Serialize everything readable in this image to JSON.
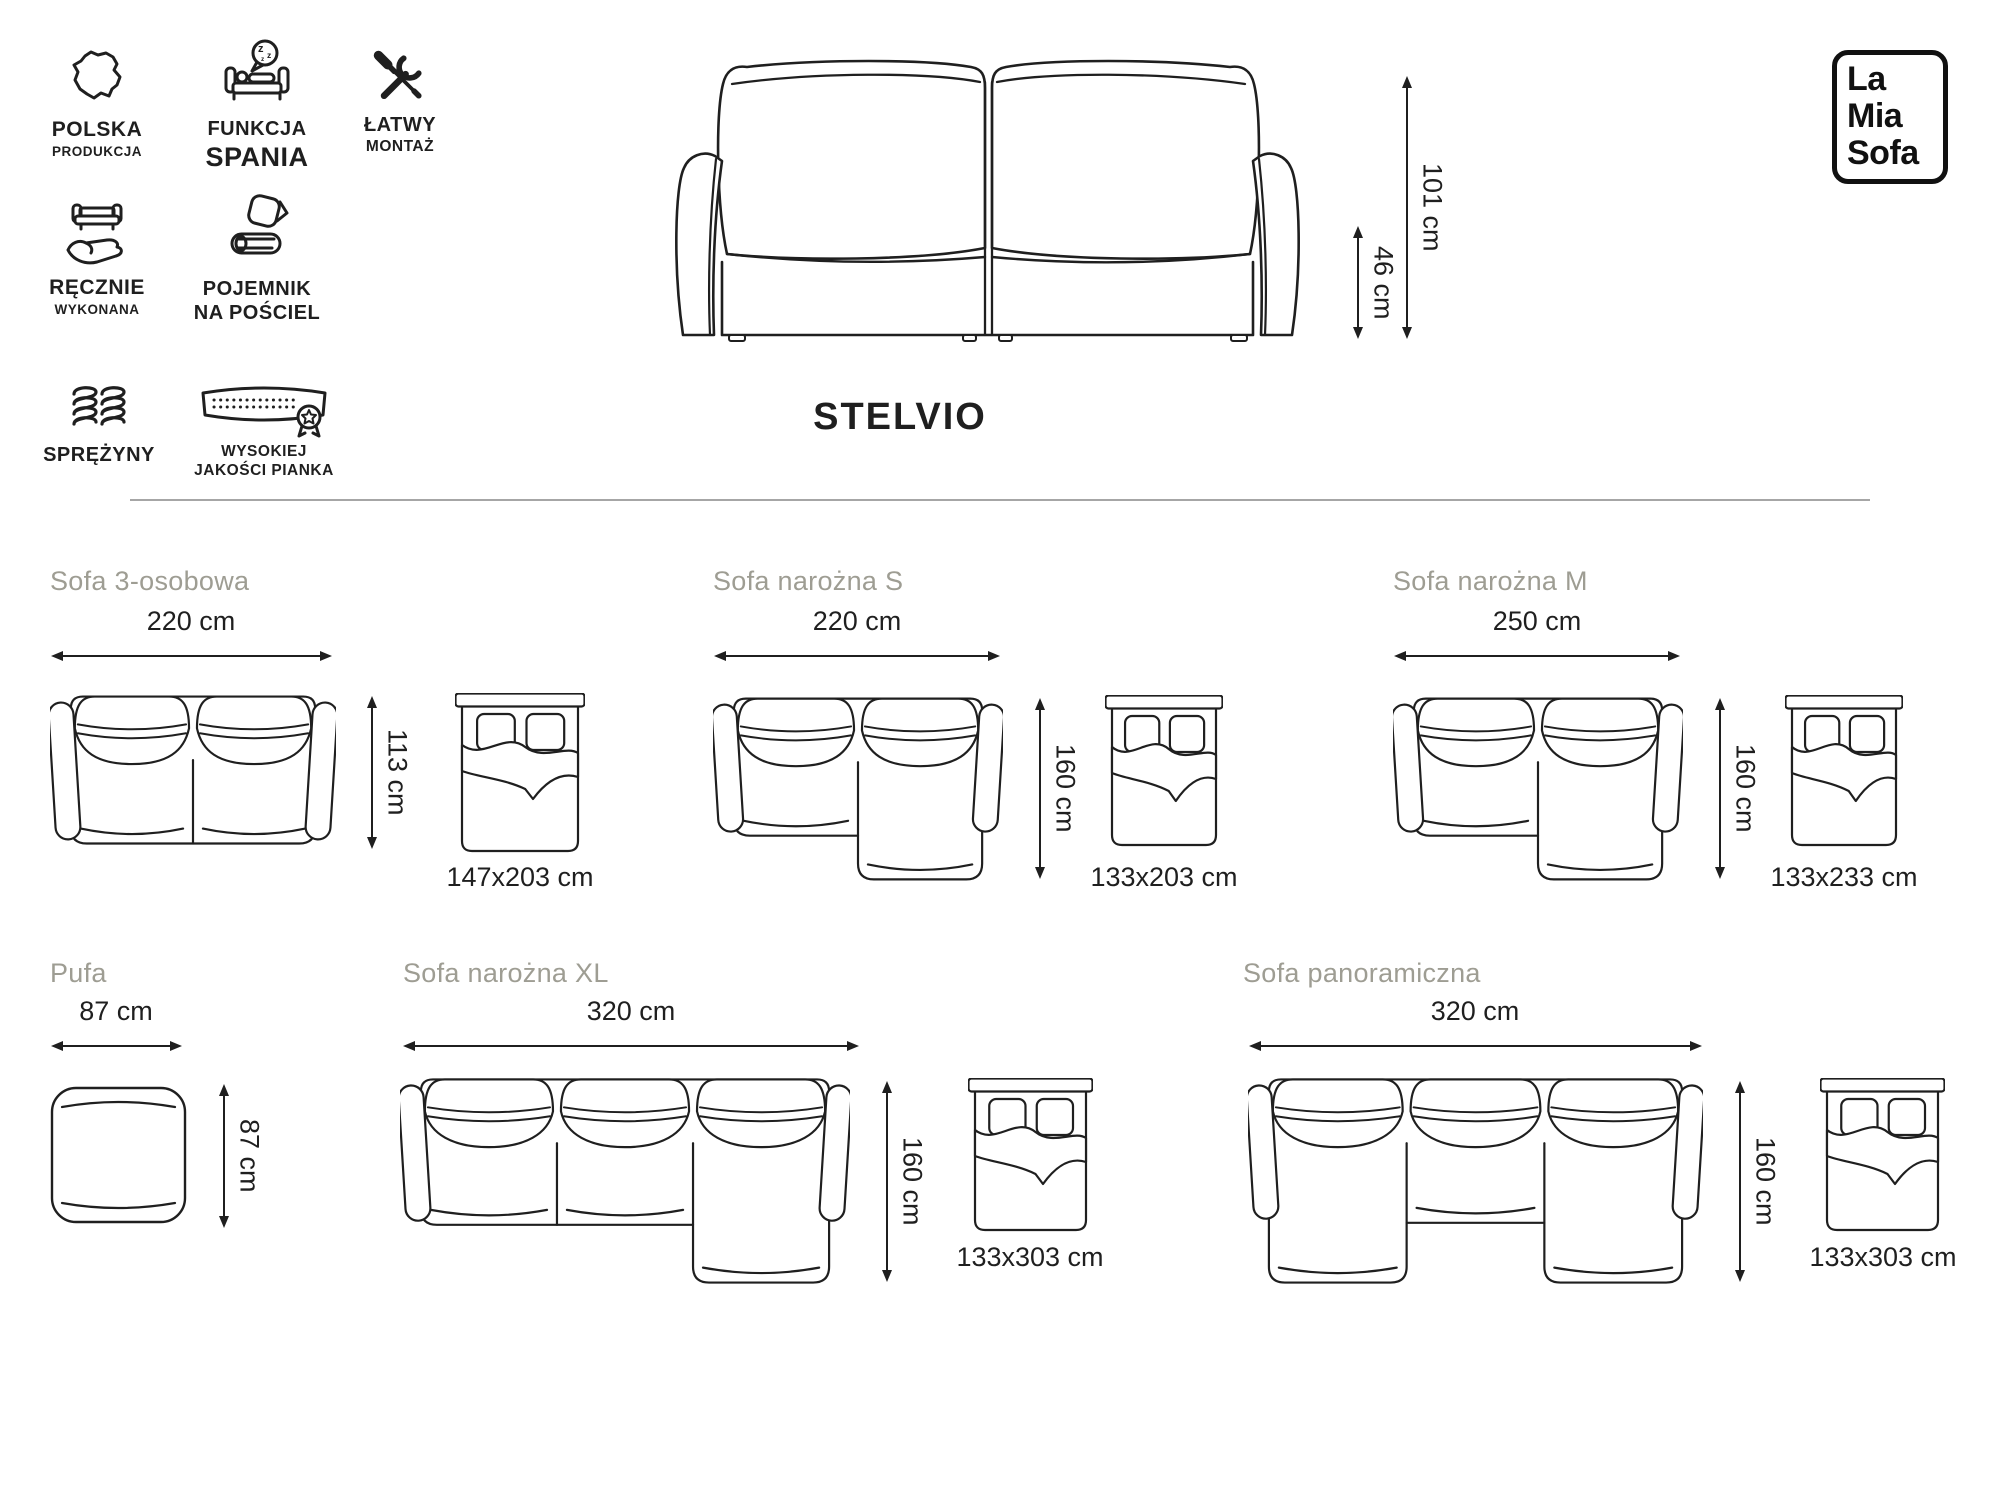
{
  "brand_logo": {
    "line1": "La",
    "line2": "Mia",
    "line3": "Sofa"
  },
  "product": {
    "name": "STELVIO",
    "height": "101 cm",
    "seat_height": "46 cm"
  },
  "features": [
    {
      "id": "poland",
      "line1": "POLSKA",
      "line2": "PRODUKCJA"
    },
    {
      "id": "sleep",
      "line1": "FUNKCJA",
      "line2": "SPANIA"
    },
    {
      "id": "assembly",
      "line1": "ŁATWY",
      "line2": "MONTAŻ"
    },
    {
      "id": "handmade",
      "line1": "RĘCZNIE",
      "line2": "WYKONANA"
    },
    {
      "id": "storage",
      "line1": "POJEMNIK",
      "line2": "NA POŚCIEL"
    },
    {
      "id": "springs",
      "line1": "SPRĘŻYNY"
    },
    {
      "id": "foam",
      "line1": "WYSOKIEJ",
      "line2": "JAKOŚCI PIANKA"
    }
  ],
  "variants": [
    {
      "name": "Sofa 3-osobowa",
      "width": "220 cm",
      "depth": "113 cm",
      "bed_size": "147x203 cm"
    },
    {
      "name": "Sofa narożna S",
      "width": "220 cm",
      "depth": "160 cm",
      "bed_size": "133x203 cm"
    },
    {
      "name": "Sofa narożna M",
      "width": "250 cm",
      "depth": "160 cm",
      "bed_size": "133x233 cm"
    },
    {
      "name": "Pufa",
      "width": "87 cm",
      "depth": "87 cm"
    },
    {
      "name": "Sofa narożna XL",
      "width": "320 cm",
      "depth": "160 cm",
      "bed_size": "133x303 cm"
    },
    {
      "name": "Sofa panoramiczna",
      "width": "320 cm",
      "depth": "160 cm",
      "bed_size": "133x303 cm"
    }
  ],
  "colors": {
    "line": "#1f1f1f",
    "muted_title": "#9e9d93",
    "divider": "#a6a6a6",
    "background": "#ffffff"
  }
}
